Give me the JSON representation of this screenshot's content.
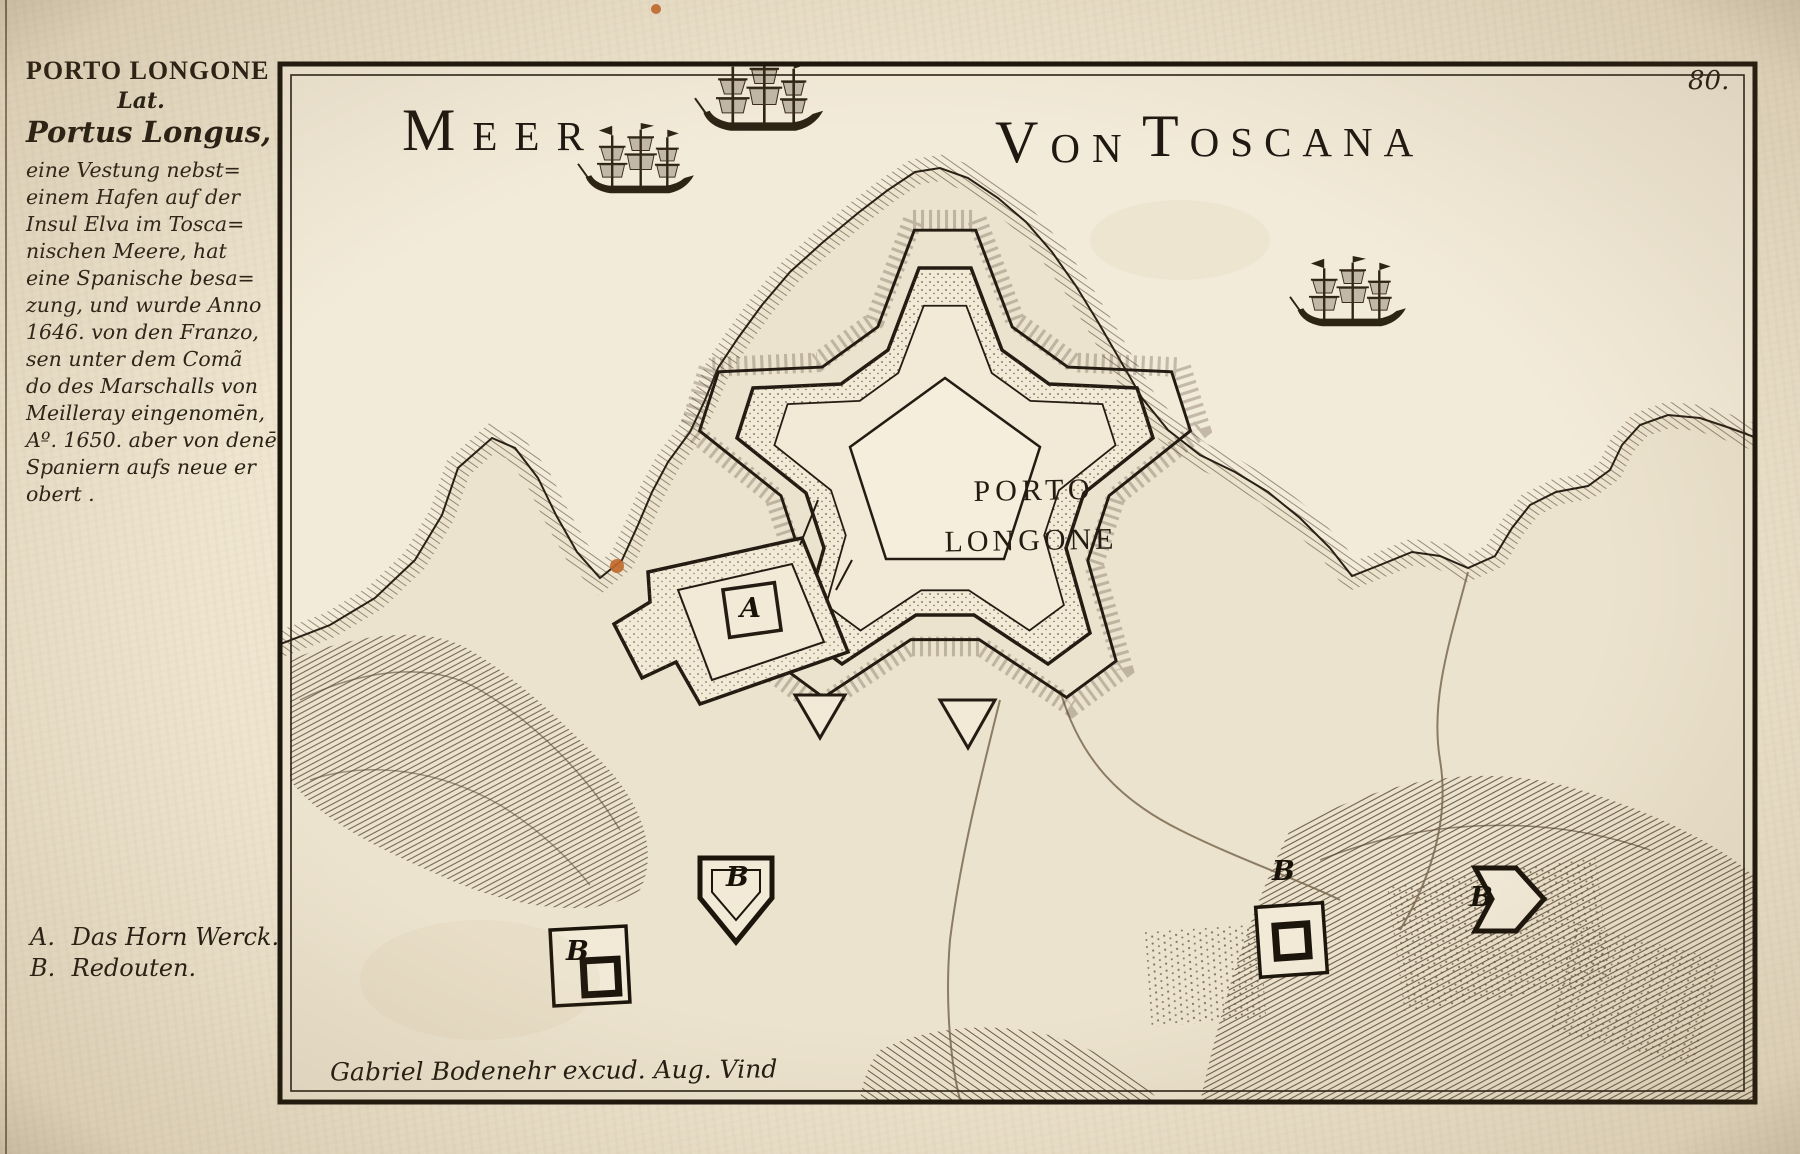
{
  "page": {
    "number": "80."
  },
  "sea_title": {
    "word1": "Meer",
    "word2": "von",
    "word3": "Toscana"
  },
  "sidebar": {
    "title": "PORTO LONGONE",
    "subtitle": "Lat.",
    "latin_name": "Portus Longus,",
    "description_lines": [
      "eine Vestung nebst=",
      "einem Hafen auf der",
      "Insul Elva im Tosca=",
      "nischen Meere, hat",
      "eine Spanische besa=",
      "zung, und wurde Anno",
      "1646. von den Franzo,",
      "sen unter dem Comã",
      "do des Marschalls von",
      "Meilleray eingenomēn,",
      "Aº. 1650. aber von denē",
      "Spaniern aufs neue er",
      "obert ."
    ],
    "legend": [
      {
        "key": "A.",
        "label": "Das Horn Werck."
      },
      {
        "key": "B.",
        "label": "Redouten."
      }
    ]
  },
  "map": {
    "fort_label": {
      "line1": "PORTO",
      "line2": "LONGONE"
    },
    "attribution": "Gabriel Bodenehr excud. Aug. Vind",
    "markers": {
      "hornwork": "A",
      "redoubt_west": "B",
      "redoubt_southwest": "B",
      "redoubt_east": "B",
      "redoubt_far_east": "B"
    }
  },
  "colors": {
    "paper": "#efe5cf",
    "ink": "#241c12",
    "engraving": "#3a2d1d",
    "stain_accent": "#c2682a"
  }
}
